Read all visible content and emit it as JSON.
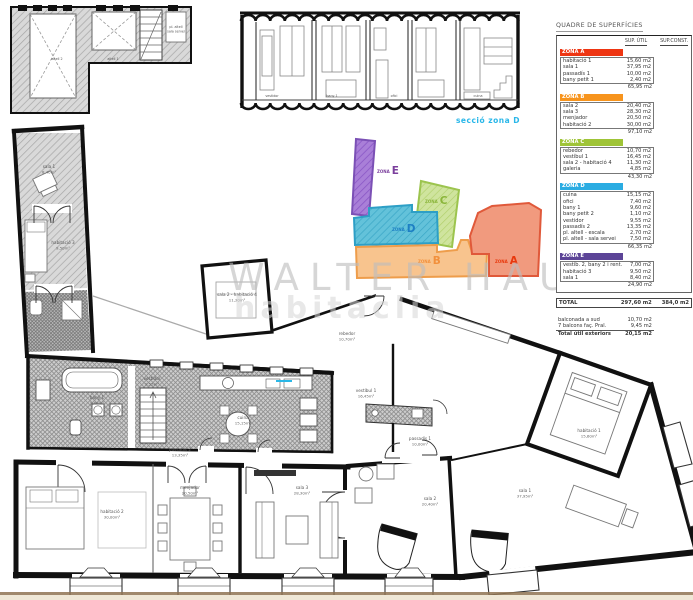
{
  "table": {
    "title": "QUADRE DE SUPERFÍCIES",
    "col_util": "SUP. ÚTIL",
    "col_const": "SUP.CONST.",
    "zones": [
      {
        "name": "ZONA A",
        "color": "#ee3512",
        "rows": [
          [
            "habitació 1",
            "15,60 m2"
          ],
          [
            "sala 1",
            "37,95 m2"
          ],
          [
            "passadís 1",
            "10,00 m2"
          ],
          [
            "bany petit 1",
            "2,40 m2"
          ]
        ],
        "subtotal": "65,95 m2"
      },
      {
        "name": "ZONA B",
        "color": "#f7941d",
        "rows": [
          [
            "sala 2",
            "20,40 m2"
          ],
          [
            "sala 3",
            "28,30 m2"
          ],
          [
            "menjador",
            "20,50 m2"
          ],
          [
            "habitació 2",
            "30,00 m2"
          ]
        ],
        "subtotal": "97,10 m2"
      },
      {
        "name": "ZONA C",
        "color": "#9fc437",
        "rows": [
          [
            "rebedor",
            "10,70 m2"
          ],
          [
            "vestíbul 1",
            "16,45 m2"
          ],
          [
            "sala 2 - habitació 4",
            "11,30 m2"
          ],
          [
            "galeria",
            "4,85 m2"
          ]
        ],
        "subtotal": "43,30 m2"
      },
      {
        "name": "ZONA D",
        "color": "#2aace2",
        "rows": [
          [
            "cuina",
            "15,15 m2"
          ],
          [
            "ofici",
            "7,40 m2"
          ],
          [
            "bany 1",
            "9,60 m2"
          ],
          [
            "bany petit 2",
            "1,10 m2"
          ],
          [
            "vestidor",
            "9,55 m2"
          ],
          [
            "passadís 2",
            "13,35 m2"
          ],
          [
            "pl. altell - escala",
            "2,70 m2"
          ],
          [
            "pl. altell - sala servei",
            "7,50 m2"
          ]
        ],
        "subtotal": "66,35 m2"
      },
      {
        "name": "ZONA E",
        "color": "#5c4497",
        "rows": [
          [
            "vestíb. 2, bany 2 i rent.",
            "7,00 m2"
          ],
          [
            "habitació 3",
            "9,50 m2"
          ],
          [
            "sala 1",
            "8,40 m2"
          ]
        ],
        "subtotal": "24,90 m2"
      }
    ],
    "total_label": "TOTAL",
    "total_util": "297,60 m2",
    "total_const": "384,0 m2",
    "exteriors": [
      {
        "name": "balconada a sud",
        "value": "10,70 m2"
      },
      {
        "name": "7 balcons faç. Pral.",
        "value": "9,45 m2"
      }
    ],
    "exterior_total_label": "Total útil exteriors",
    "exterior_total": "20,15 m2"
  },
  "zone_diagram": {
    "zones": [
      {
        "word": "ZONA",
        "letter": "E",
        "color": "#7b3f9d"
      },
      {
        "word": "ZONA",
        "letter": "C",
        "color": "#8ab53a"
      },
      {
        "word": "ZONA",
        "letter": "D",
        "color": "#1d7fc4"
      },
      {
        "word": "ZONA",
        "letter": "B",
        "color": "#f2903c"
      },
      {
        "word": "ZONA",
        "letter": "A",
        "color": "#e8380d"
      }
    ]
  },
  "section": {
    "label": "secció zona D"
  },
  "watermark": {
    "line1": "WALTER HAUS",
    "line2": "habitaclia"
  },
  "plan": {
    "labels": [
      {
        "name": "sala 1",
        "area": "8,40m²"
      },
      {
        "name": "habitació 3",
        "area": "9,50m²"
      },
      {
        "name": "menjador",
        "area": "20,50m²"
      },
      {
        "name": "habitació 2",
        "area": "30,00m²"
      },
      {
        "name": "sala 3",
        "area": "28,30m²"
      },
      {
        "name": "sala 2",
        "area": "20,40m²"
      },
      {
        "name": "sala 1",
        "area": "37,95m²"
      },
      {
        "name": "habitació 1",
        "area": "15,60m²"
      },
      {
        "name": "passadís 1",
        "area": "10,00m²"
      },
      {
        "name": "vestíbul 1",
        "area": "16,45m²"
      },
      {
        "name": "rebedor",
        "area": "10,70m²"
      },
      {
        "name": "cuina",
        "area": "15,15m²"
      },
      {
        "name": "bany 1",
        "area": "9,60m²"
      },
      {
        "name": "vestidor",
        "area": "9,55m²"
      },
      {
        "name": "passadís 2",
        "area": "13,35m²"
      },
      {
        "name": "sala 2 - habitació 4",
        "area": "11,30m²"
      },
      {
        "name": "altell 1",
        "area": ""
      },
      {
        "name": "altell 2",
        "area": ""
      },
      {
        "name": "pl. altell",
        "area": "sala servei"
      },
      {
        "name": "vestidor",
        "area": ""
      },
      {
        "name": "bany 1",
        "area": ""
      },
      {
        "name": "ofici",
        "area": ""
      },
      {
        "name": "cuina",
        "area": ""
      }
    ]
  }
}
